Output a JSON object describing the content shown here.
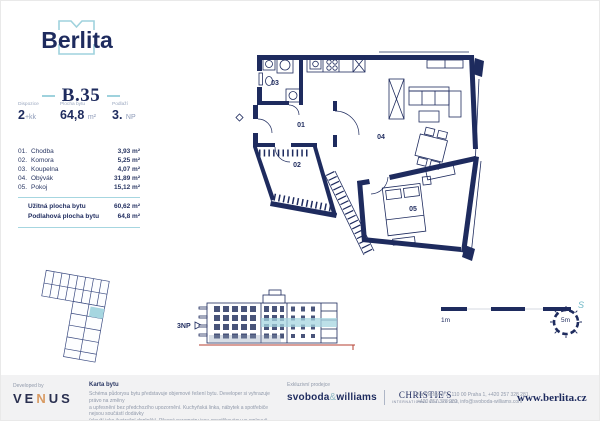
{
  "brand": {
    "name": "Berlita",
    "website": "www.berlita.cz"
  },
  "unit": {
    "id": "B.35",
    "specs": [
      {
        "label": "Dispozice",
        "value": "2",
        "suffix": "+kk"
      },
      {
        "label": "Plocha bytu",
        "value": "64,8",
        "suffix": "m²"
      },
      {
        "label": "Podlaží",
        "value": "3.",
        "suffix": "NP"
      }
    ]
  },
  "rooms": [
    {
      "num": "01.",
      "name": "Chodba",
      "area": "3,93 m²"
    },
    {
      "num": "02.",
      "name": "Komora",
      "area": "5,25 m²"
    },
    {
      "num": "03.",
      "name": "Koupelna",
      "area": "4,07 m²"
    },
    {
      "num": "04.",
      "name": "Obývák",
      "area": "31,89 m²"
    },
    {
      "num": "05.",
      "name": "Pokoj",
      "area": "15,12 m²"
    }
  ],
  "totals": [
    {
      "label": "Užitná plocha bytu",
      "value": "60,62 m²"
    },
    {
      "label": "Podlahová plocha bytu",
      "value": "64,8 m²"
    }
  ],
  "plan_labels": {
    "r01": "01",
    "r02": "02",
    "r03": "03",
    "r04": "04",
    "r05": "05"
  },
  "elevation": {
    "floor_label": "3NP"
  },
  "scale_bar": {
    "start": "1m",
    "end": "5m"
  },
  "compass": {
    "north": "S"
  },
  "footer": {
    "developed_by": "Developed by",
    "developer_parts": {
      "p1": "VE",
      "p2": "N",
      "p3": "US"
    },
    "card_title": "Karta bytu",
    "disclaimer": [
      "Schéma půdorysu bytu představuje objemové řešení bytu. Developer si vyhrazuje právo na změny",
      "a upřesnění bez předchozího upozornění. Kuchyňská linka, nábytek a spotřebiče nejsou součástí dodávky",
      "(slouží jako ilustrační doplněk). Přesné parametry jsou specifikovány ve smlouvě."
    ],
    "broker_label": "Exkluzivní prodejce",
    "broker1_parts": {
      "p1": "svoboda",
      "amp": "&",
      "p2": "williams"
    },
    "broker2": "CHRISTIE'S",
    "broker2_sub": "INTERNATIONAL REAL ESTATE",
    "contact_lines": [
      "Na Perštýně 2, 110 00 Praha 1, +420 257 328 281,",
      "+420 257 328 282, info@svoboda-williams.com"
    ]
  },
  "colors": {
    "navy": "#1e2b5e",
    "accent": "#a6d6e0",
    "orange": "#d89a62",
    "red": "#b43f32"
  }
}
